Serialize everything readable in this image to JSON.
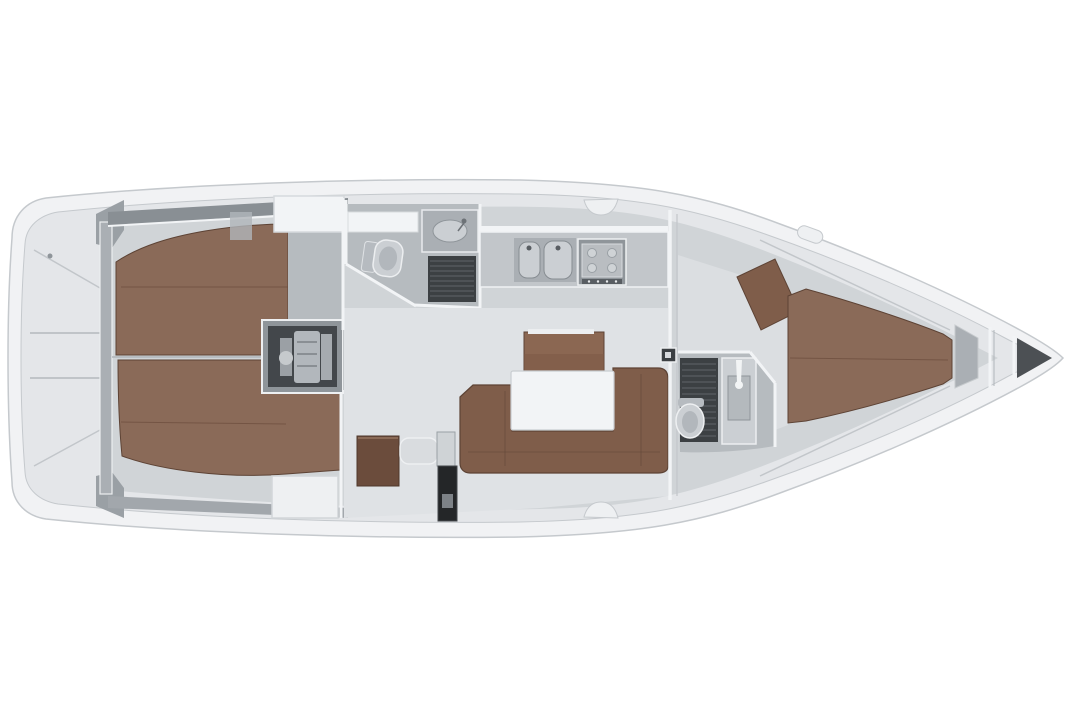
{
  "scene": {
    "subject": "sailing-yacht-interior-floor-plan",
    "orientation": "bow-right",
    "rooms": [
      "stern-lazarette",
      "aft-cabin-port",
      "aft-cabin-starboard",
      "engine-compartment",
      "companionway",
      "aft-head",
      "galley",
      "salon",
      "nav-station",
      "forward-head",
      "forward-cabin",
      "anchor-locker"
    ]
  },
  "colors": {
    "background": "#ffffff",
    "hull": "#f1f2f4",
    "hull_line": "#c5c9cd",
    "deck": "#e4e6e9",
    "interior": "#d0d4d7",
    "floor_light": "#dfe2e5",
    "floor_lighter": "#dbdee1",
    "floor_white": "#eef0f2",
    "wall_white": "#f2f4f6",
    "wall_gray": "#9aa0a5",
    "band_dark": "#898f94",
    "band_mid": "#a2a7ac",
    "cabin_floor": "#b6bbbf",
    "wood": "#8a6a58",
    "wood_mid": "#7f5d4a",
    "wood_dark": "#6b4c3c",
    "wood_edge": "#5d4335",
    "sideboard": "#8b6752",
    "grate": "#3c4043",
    "grate_slat": "#60656a",
    "engine_frame": "#8f959a",
    "engine_box": "#43474b",
    "engine_part": "#b2b7bc",
    "fixture": "#cbcfd3",
    "fixture_mid": "#aaafb4",
    "step": "#d9dcdf",
    "dark_locker": "#242628",
    "bow_dark": "#4c5054"
  }
}
